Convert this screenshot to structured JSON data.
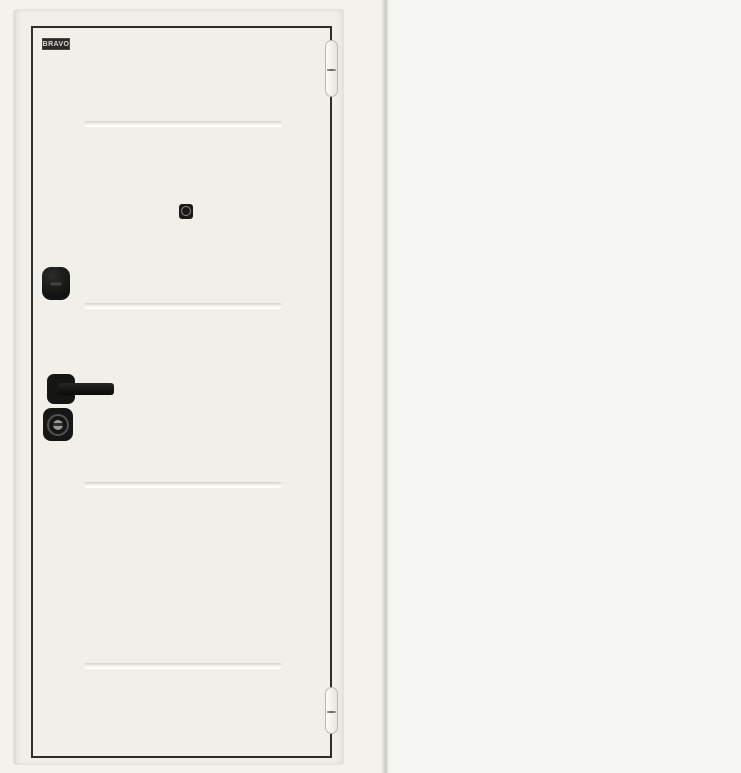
{
  "image": {
    "width_px": 741,
    "height_px": 773
  },
  "brand": {
    "logo_text": "BRAVO",
    "logo_bg": "#2b2a27",
    "logo_fg": "#d9d8d3"
  },
  "colors": {
    "front_face": "#f0efe9",
    "front_outline": "#2e2d29",
    "back_frame": "#edebe3",
    "back_leaf": "#fcfcfd",
    "hardware_black": "#141413",
    "photo_background": "#f4f3ef",
    "divider_gray": "#cbcac4"
  },
  "front_door": {
    "groove_lines": 4,
    "hardware": [
      "peephole-icon",
      "thumbturn-escutcheon",
      "lever-handle",
      "key-cylinder-escutcheon"
    ],
    "hinges": [
      "top-hinge",
      "bottom-hinge"
    ]
  },
  "back_door": {
    "hardware": [
      "peephole-icon",
      "thumbturn-upper",
      "thumbturn-lower",
      "lever-handle",
      "key-cylinder"
    ],
    "seam_line": "horizontal-accent-groove"
  }
}
